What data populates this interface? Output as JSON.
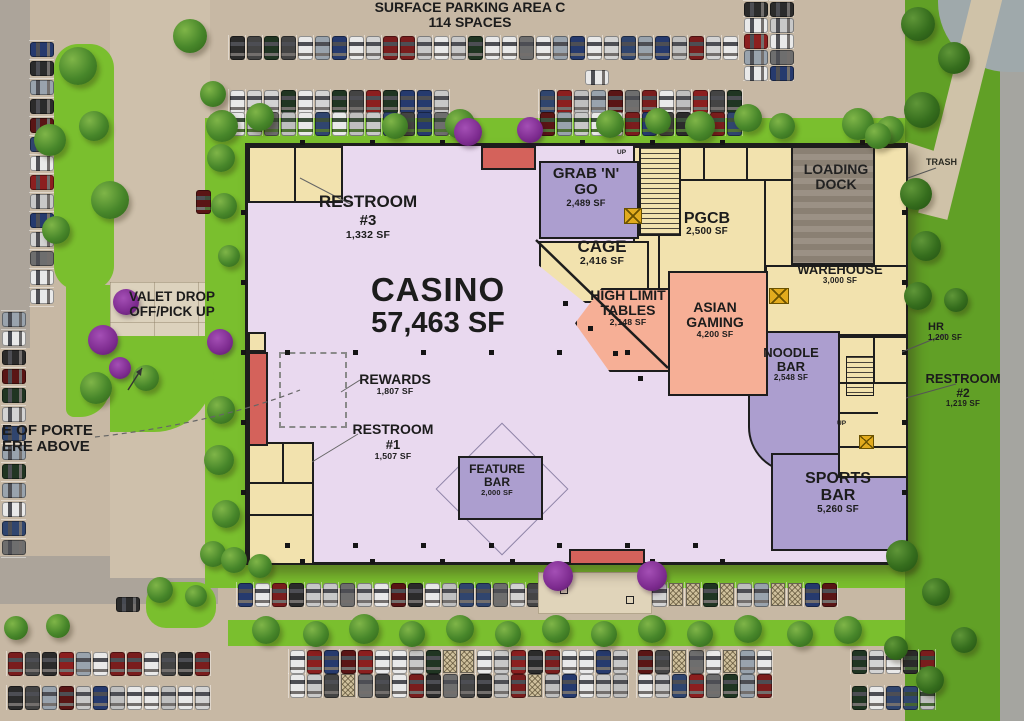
{
  "title": {
    "line1": "SURFACE PARKING AREA C",
    "line2": "114 SPACES"
  },
  "rooms": {
    "casino": {
      "name": "CASINO",
      "sf": "57,463 SF"
    },
    "restroom3": {
      "line1": "RESTROOM",
      "line2": "#3",
      "sf": "1,332 SF"
    },
    "grab_n_go": {
      "line1": "GRAB 'N'",
      "line2": "GO",
      "sf": "2,489 SF"
    },
    "cage": {
      "name": "CAGE",
      "sf": "2,416 SF"
    },
    "pgcb": {
      "name": "PGCB",
      "sf": "2,500 SF"
    },
    "loading_dock": {
      "line1": "LOADING",
      "line2": "DOCK"
    },
    "warehouse": {
      "name": "WAREHOUSE",
      "sf": "3,000 SF"
    },
    "high_limit": {
      "line1": "HIGH LIMIT",
      "line2": "TABLES",
      "sf": "2,148 SF"
    },
    "asian_gaming": {
      "line1": "ASIAN",
      "line2": "GAMING",
      "sf": "4,200 SF"
    },
    "noodle_bar": {
      "line1": "NOODLE",
      "line2": "BAR",
      "sf": "2,548 SF"
    },
    "rewards": {
      "name": "REWARDS",
      "sf": "1,807 SF"
    },
    "restroom1": {
      "line1": "RESTROOM",
      "line2": "#1",
      "sf": "1,507 SF"
    },
    "feature_bar": {
      "line1": "FEATURE",
      "line2": "BAR",
      "sf": "2,000 SF"
    },
    "sports_bar": {
      "line1": "SPORTS",
      "line2": "BAR",
      "sf": "5,260 SF"
    },
    "hr": {
      "name": "HR",
      "sf": "1,200 SF"
    },
    "restroom2": {
      "line1": "RESTROOM",
      "line2": "#2",
      "sf": "1,219 SF"
    }
  },
  "labels": {
    "valet_line1": "VALET DROP",
    "valet_line2": "OFF/PICK UP",
    "porte_line1": "E OF PORTE",
    "porte_line2": "ERE ABOVE",
    "trash": "TRASH",
    "up": "UP"
  },
  "colors": {
    "casino_floor": "#e9d9ef",
    "purple_room": "#ac9ecf",
    "tan_room": "#f2e2ae",
    "salmon_room": "#f6af96",
    "entrance_red": "#d4625b",
    "dock_gray": "#9a9083",
    "grass_bright": "#7abf2e",
    "grass_dark": "#61a026",
    "tree_green": "#3f7d21",
    "bush_purple": "#7d2b8f",
    "pavement": "#c7b8a4",
    "road": "#aca49a",
    "wall": "#1d1d1d",
    "car_palette": [
      "#e9e9e9",
      "#d3d3d3",
      "#bfbfbf",
      "#2b2b2b",
      "#8c1f1f",
      "#263a6e",
      "#6e6e6e",
      "#e9e9e9",
      "#c8c8c8",
      "#203522",
      "#5a1515",
      "#30456e",
      "#e9e9e9",
      "#99a3ad",
      "#444444",
      "#7a1d1d"
    ]
  }
}
